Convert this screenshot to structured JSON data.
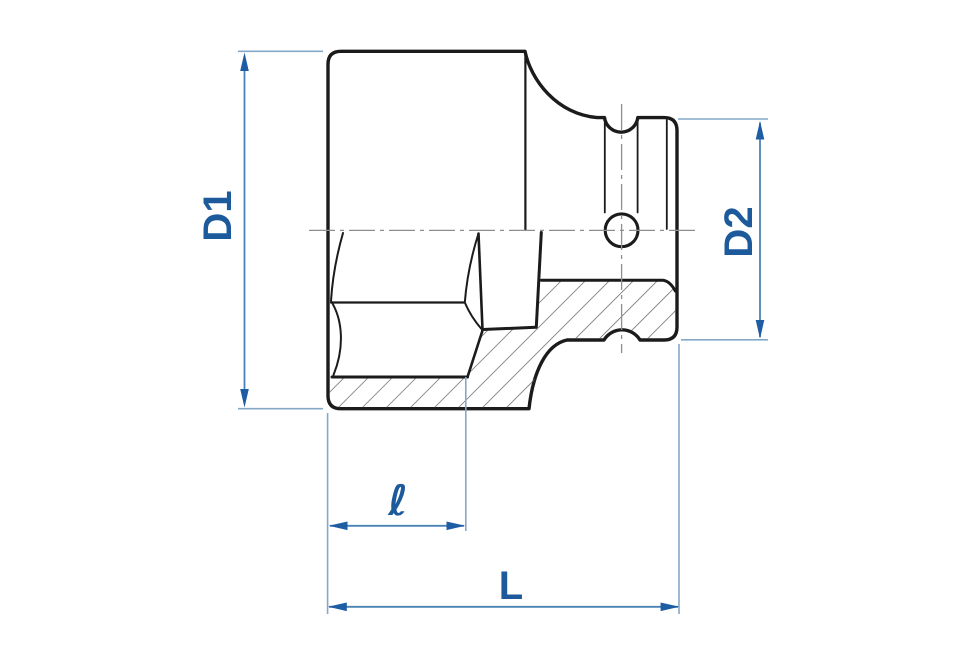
{
  "drawing": {
    "labels": {
      "d1": "D1",
      "d2": "D2",
      "inner_depth": "ℓ",
      "overall_length": "L"
    },
    "colors": {
      "background": "#ffffff",
      "outline": "#1b1b1b",
      "hatch": "#606060",
      "centerline": "#8f8f8f",
      "dim_line": "#4b82b5",
      "ext_line": "#84a8c8",
      "arrow": "#1e5ca3",
      "dim_text": "#1d5a9c"
    }
  }
}
